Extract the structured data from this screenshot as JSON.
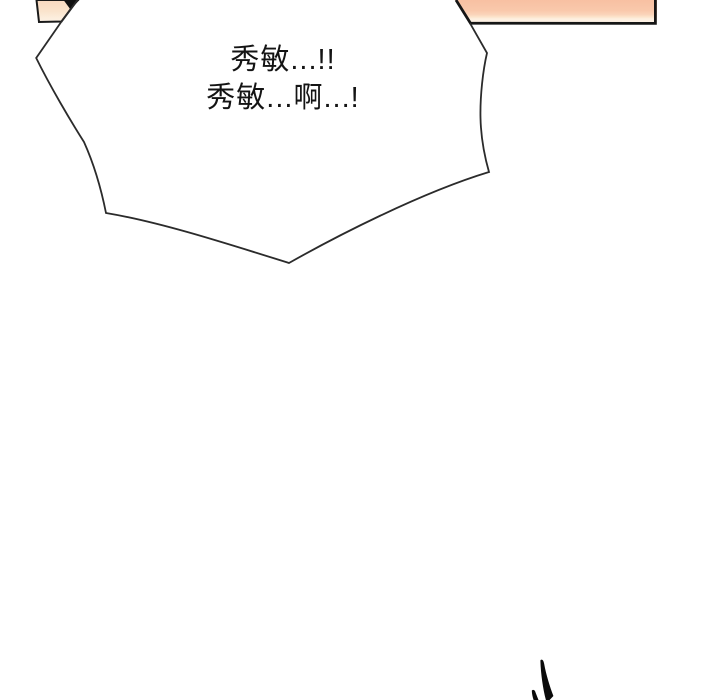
{
  "page": {
    "kind": "comic-panel",
    "background": "#ffffff"
  },
  "speech_bubble": {
    "line1": "秀敏...!!",
    "line2": "秀敏...啊...!"
  },
  "colors": {
    "bubble_outline": "#2b2b2b",
    "panel_border": "#161616",
    "ink": "#0b0b0b",
    "peach_top": "#f8c0a2",
    "peach_mid": "#f9c8ab",
    "peach_warm": "#fad3b9",
    "peach_cream": "#fdefe0",
    "peach_cream_edge": "#fdf2e6",
    "peach_light_top": "#f8d9c0",
    "peach_light_mid": "#fae3cc",
    "peach_light_cream": "#fdf2e6"
  }
}
